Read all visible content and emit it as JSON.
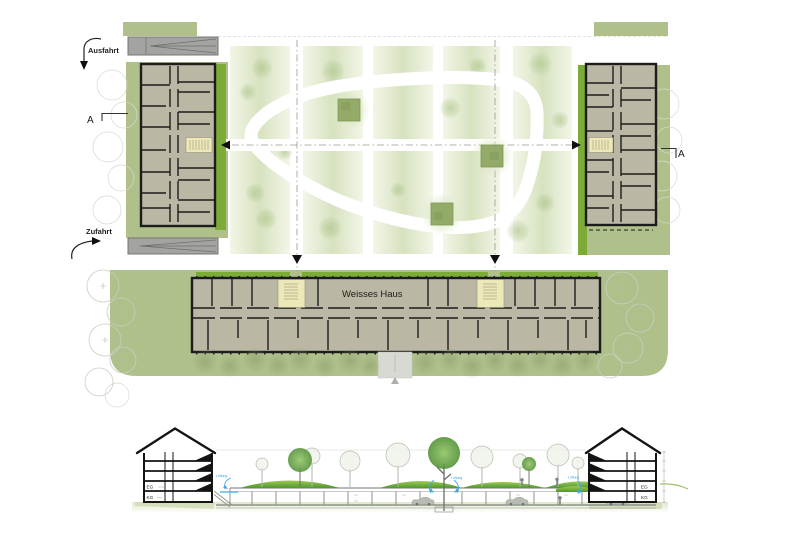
{
  "site_plan": {
    "labels": {
      "exit": "Ausfahrt",
      "access": "Zufahrt",
      "section_left": "A",
      "section_right": "A",
      "building": "Weisses Haus"
    }
  },
  "section_view": {
    "labels": {
      "eg_left": "EG",
      "kg_left": "KG",
      "eg_right": "EG",
      "kg_right": "KG",
      "vent_left": "Lüftung",
      "vent_mid": "Lüftung",
      "vent_right": "Lüftung"
    }
  },
  "colors": {
    "sage_green": "#afc08b",
    "bright_green": "#7cab38",
    "plan_fill": "#bab7a5",
    "wall_black": "#1c1c1a",
    "core_yellow": "#ece8b8",
    "ramp_gray": "#a3a3a1",
    "tree_outline": "#c9cec0",
    "stripe_mid": "#d7e2bf",
    "stripe_edge": "#f2f6e8",
    "fuzz_green": "#a9c184",
    "halo_green": "#dce8c6",
    "olive_green": "#8da06b",
    "mound_light": "#9ccb52",
    "mound_dark": "#4f9730",
    "leaf_light": "#8cc25f",
    "leaf_dark": "#4e8f33",
    "earth_light": "#dfe8ca",
    "annotation_blue": "#3fa7e6",
    "garage_gray": "#8d938a",
    "path_white": "#ffffff"
  }
}
